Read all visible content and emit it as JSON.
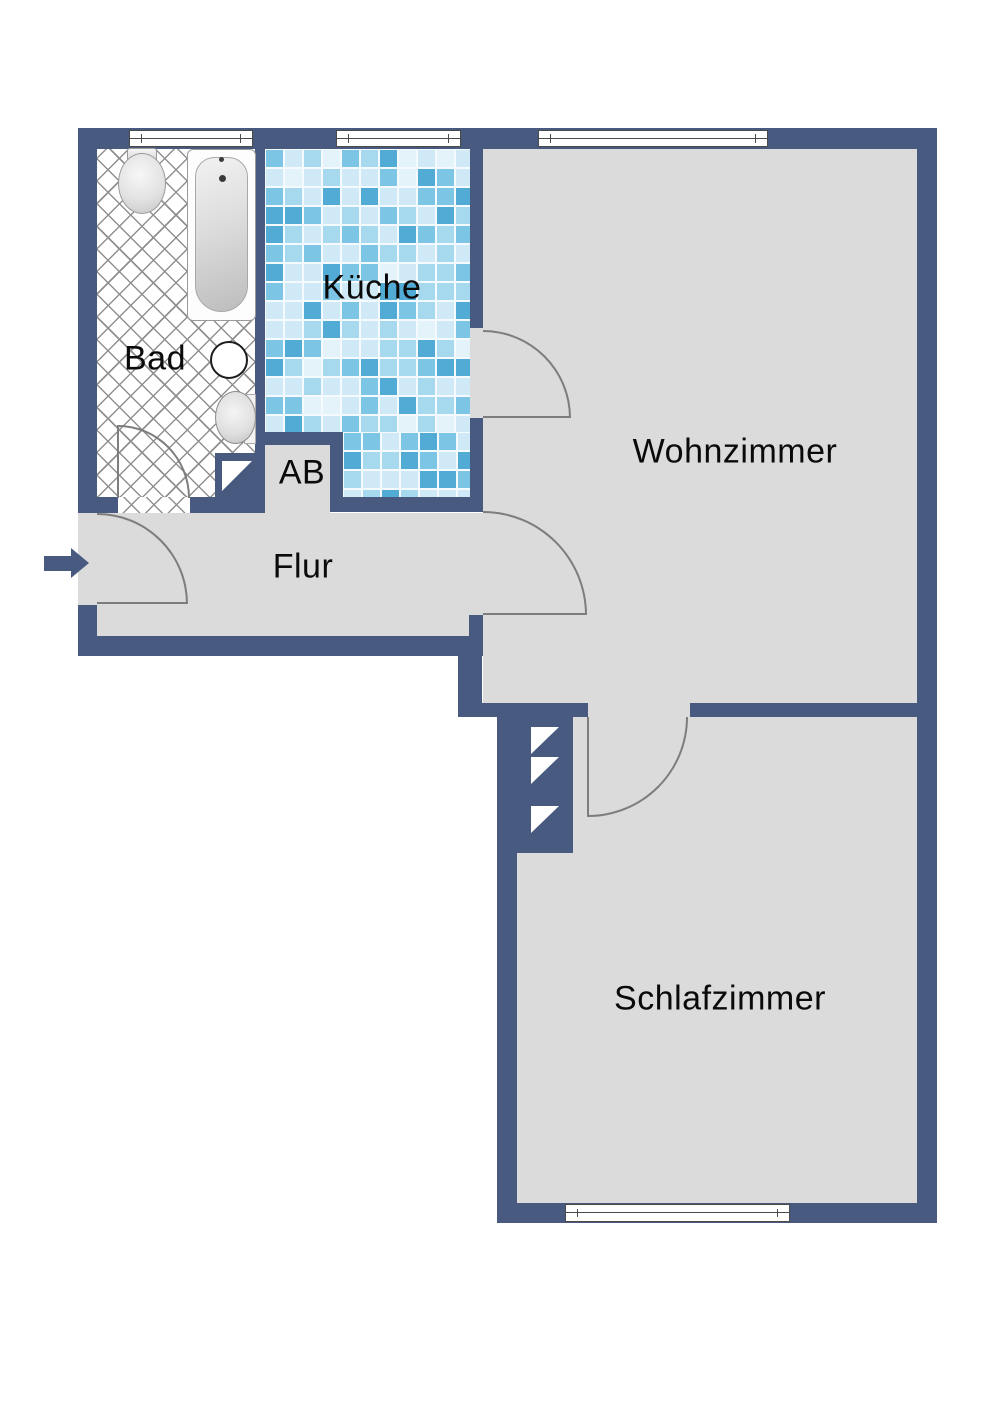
{
  "rooms": {
    "bad": {
      "label": "Bad"
    },
    "kueche": {
      "label": "Küche"
    },
    "ab": {
      "label": "AB"
    },
    "flur": {
      "label": "Flur"
    },
    "wohnzimmer": {
      "label": "Wohnzimmer"
    },
    "schlafzimmer": {
      "label": "Schlafzimmer"
    }
  },
  "symbols": {
    "entrance_arrow": {
      "icon": "entrance-arrow-icon",
      "direction": "right"
    },
    "windows": {
      "count": 4,
      "locations": [
        "bad-top",
        "kueche-top",
        "wohnzimmer-top",
        "schlafzimmer-bottom"
      ]
    },
    "door_arcs": {
      "count": 5,
      "locations": [
        "entrance-to-flur",
        "bad",
        "kueche-to-wohnzimmer",
        "flur-to-wohnzimmer",
        "wohnzimmer-to-schlafzimmer"
      ]
    },
    "duct_shaft": {
      "triangle_count": 3
    },
    "fixtures": [
      "toilet",
      "bathtub",
      "washbasin",
      "round-basin"
    ]
  },
  "colors": {
    "wall": "#485a7f",
    "floor": "#dbdbdb",
    "door_arc": "#7d7d7d",
    "hatch_line": "#909090",
    "text": "#0a0a0a",
    "grout": "#f4fafd",
    "tile_palette": [
      "#cfeaf6",
      "#a6d9ee",
      "#7cc5e4",
      "#51abd4",
      "#e4f3fa"
    ]
  }
}
